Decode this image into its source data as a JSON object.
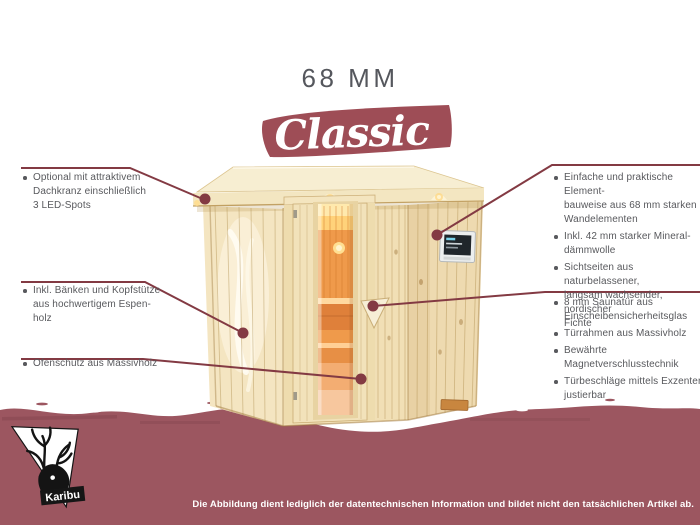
{
  "page": {
    "title": "68 MM",
    "series": "Classic"
  },
  "brand": {
    "name": "Karibu"
  },
  "features_left": [
    "Optional mit attraktivem\nDachkranz einschließlich\n3 LED-Spots",
    "Inkl. Bänken und Kopfstütze\naus hochwertigem Espen-\nholz",
    "Ofenschutz aus Massivholz"
  ],
  "features_right_construction": [
    "Einfache und praktische Element-\nbauweise aus 68 mm starken\nWandelementen",
    "Inkl. 42 mm starker Mineral-\ndämmwolle",
    "Sichtseiten aus naturbelassener,\nlangsam wachsender, nordischer\nFichte"
  ],
  "features_right_door": [
    "8 mm Saunatür aus\nEinscheibensicherheitsglas",
    "Türrahmen aus Massivholz",
    "Bewährte Magnetverschlusstechnik",
    "Türbeschläge mittels Exzenter\njustierbar"
  ],
  "disclaimer": "Die Abbildung dient lediglich der datentechnischen Information und bildet nicht den tatsächlichen Artikel ab.",
  "colors": {
    "band": "#9c5660",
    "banner": "#9e4d56",
    "callout": "#833a43",
    "title_text": "#55575d",
    "body_text": "#58595d",
    "wood": "#f1dfb5",
    "glass_glow": "#ef9a4b"
  }
}
